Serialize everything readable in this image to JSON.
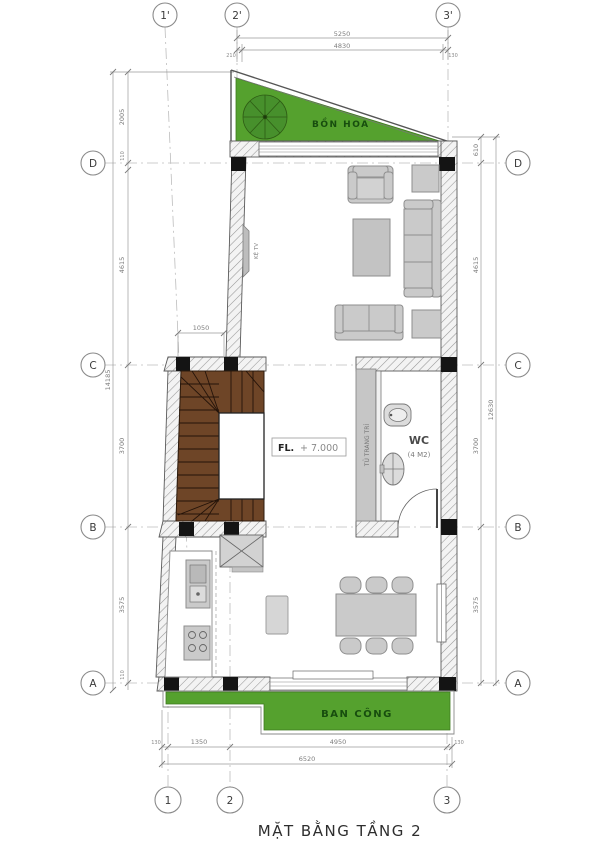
{
  "title": "MẶT BẰNG TẦNG 2",
  "grid": {
    "top": [
      "1'",
      "2'",
      "3'"
    ],
    "bottom": [
      "1",
      "2",
      "3"
    ],
    "left": [
      "D",
      "C",
      "B",
      "A"
    ],
    "right": [
      "D",
      "C",
      "B",
      "A"
    ]
  },
  "dims": {
    "top": {
      "total": "5250",
      "inner": "4830",
      "left_end": "210",
      "right_end": "130"
    },
    "bottom": {
      "seg1": "1350",
      "seg2": "4950",
      "total": "6520",
      "left_end": "130",
      "right_end": "130"
    },
    "left": {
      "top": "2005",
      "d_off": "110",
      "dc": "4615",
      "cb": "3700",
      "ba": "3575",
      "a_off": "110",
      "overall": "14185"
    },
    "right": {
      "d_off": "610",
      "dc": "4615",
      "cb": "3700",
      "ba": "3575",
      "overall": "12630"
    },
    "stair": "1050"
  },
  "labels": {
    "flower_box": "BỒN HOA",
    "balcony": "BAN CÔNG",
    "wc": "WC",
    "wc_area": "(4 M2)",
    "tv_shelf": "KỆ TV",
    "cabinet": "TỦ TRANG TRÍ",
    "level_prefix": "FL.",
    "level_value": "+ 7.000"
  },
  "colors": {
    "grass": "#55a12e",
    "grass_dark": "#3f7a1e",
    "tree": "#47902c",
    "stair_wood": "#6e4527",
    "column": "#141414",
    "furniture": "#cacaca"
  }
}
